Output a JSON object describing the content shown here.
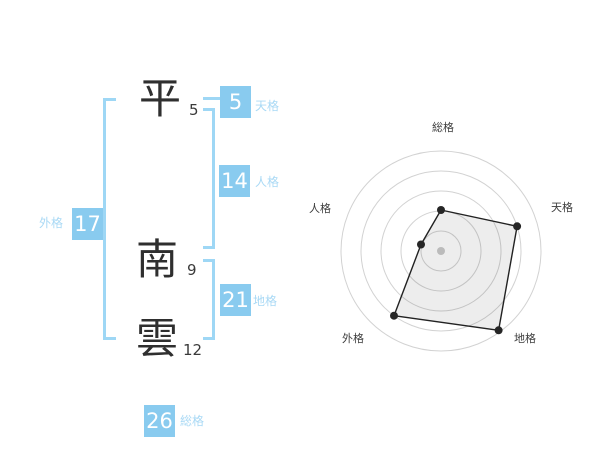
{
  "name_panel": {
    "surname": [
      {
        "char": "平",
        "strokes": "5"
      }
    ],
    "given_name": [
      {
        "char": "南",
        "strokes": "9"
      },
      {
        "char": "雲",
        "strokes": "12"
      }
    ],
    "badges": {
      "tenkaku": {
        "value": "5",
        "label": "天格"
      },
      "jinkaku": {
        "value": "14",
        "label": "人格"
      },
      "chikaku": {
        "value": "21",
        "label": "地格"
      },
      "gaikaku": {
        "value": "17",
        "label": "外格"
      },
      "soukaku": {
        "value": "26",
        "label": "総格"
      }
    }
  },
  "colors": {
    "badge_blue": "#89CBEF",
    "label_blue": "#A9D9F5",
    "bracket_blue": "#9ED7F5",
    "kanji_dark": "#2F2F2F",
    "radar_grid_gray": "#D2D2D2",
    "radar_polygon_stroke": "#222222",
    "radar_polygon_fill": "rgba(0,0,0,0.07)",
    "radar_dot": "#262626",
    "radar_center_dot": "#BBBBBB"
  },
  "chart_data": {
    "type": "radar",
    "categories": [
      "総格",
      "天格",
      "地格",
      "外格",
      "人格"
    ],
    "values": [
      41,
      80,
      98,
      80,
      21
    ],
    "max": 100,
    "rings": 5,
    "start_angle_deg": -90,
    "direction": "clockwise",
    "grid": "concentric-circles",
    "legend": false,
    "title": ""
  }
}
